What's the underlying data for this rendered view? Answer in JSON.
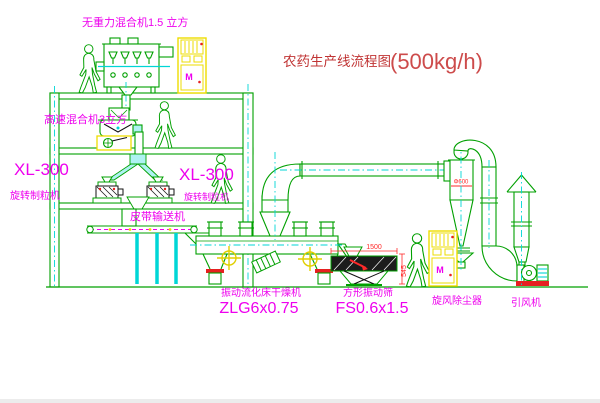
{
  "title": {
    "zh": "农药生产线流程图",
    "capacity": "(500kg/h)"
  },
  "equipment_labels": {
    "gravity_mixer": "无重力混合机1.5 立方",
    "high_speed_mixer": "高速混合机3立方",
    "granulator_left": {
      "model": "XL-300",
      "name": "旋转制粒机"
    },
    "granulator_right": {
      "model": "XL-300",
      "name": "旋转制粒机"
    },
    "belt_conveyor": "皮带输送机",
    "fluid_bed_dryer": {
      "name": "振动流化床干燥机",
      "model": "ZLG6x0.75"
    },
    "square_screen": {
      "name": "方形振动筛",
      "model": "FS0.6x1.5"
    },
    "cyclone": "旋风除尘器",
    "induced_draft_fan": "引风机"
  },
  "dimensions": {
    "screen_length": "1500",
    "screen_outlet_height": "545",
    "cyclone_diameter": "Φ600"
  },
  "symbols": {
    "motor": "M"
  },
  "colors": {
    "line_green": "#00a000",
    "centerline_cyan": "#00d6d6",
    "label_magenta": "#ee00ee",
    "title_red": "#c03434",
    "cabinet_yellow": "#eedd00",
    "dimension_red": "#ff2a2a",
    "detail_black": "#111111"
  }
}
